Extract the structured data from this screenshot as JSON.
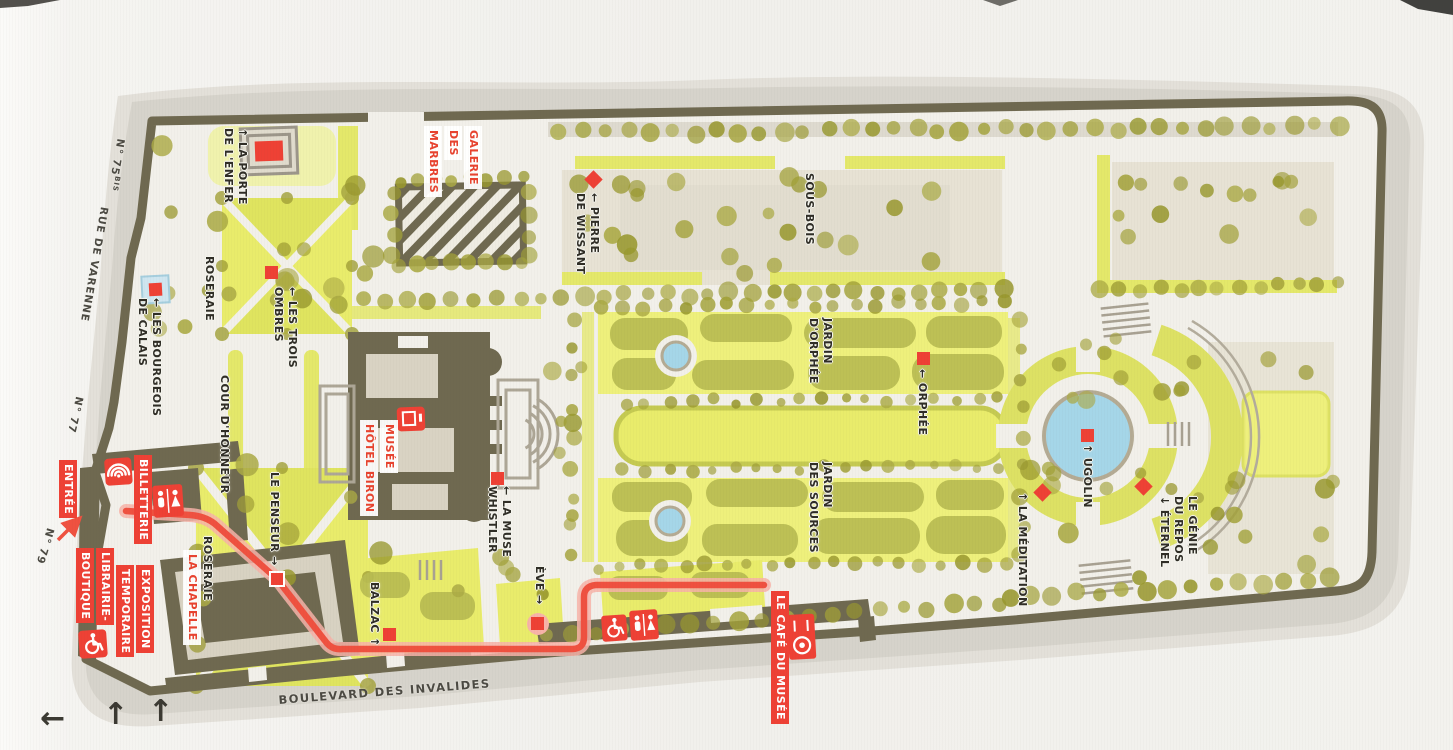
{
  "colors": {
    "accent_red": "#ee4135",
    "wall_olive": "#6f6950",
    "lawn_bright": "#e9ec6b",
    "lawn_band": "#dde164",
    "hedge_olive": "#b9bc52",
    "water_blue": "#a5d6e8",
    "tree_olive": "#a2a138",
    "paper": "#f2f0ea"
  },
  "streets": {
    "rue_de_varenne": "RUE DE VARENNE",
    "boulevard_des_invalides": "BOULEVARD DES INVALIDES",
    "n75": "N° 75",
    "n75_sup": "BIS",
    "n77": "N° 77",
    "n79": "N° 79"
  },
  "arrows": {
    "west": "←",
    "up1": "↑",
    "up2": "↑"
  },
  "garden_labels": [
    {
      "id": "la-porte-de-l-enfer",
      "lines": [
        "↑ LA PORTE",
        "DE L'ENFER"
      ]
    },
    {
      "id": "roseraie-nord",
      "lines": [
        "ROSERAIE"
      ]
    },
    {
      "id": "les-trois-ombres",
      "lines": [
        "← LES TROIS",
        "OMBRES"
      ]
    },
    {
      "id": "les-bourgeois-de-calais",
      "lines": [
        "← LES BOURGEOIS",
        "DE CALAIS"
      ]
    },
    {
      "id": "cour-d-honneur",
      "lines": [
        "COUR D'HONNEUR"
      ]
    },
    {
      "id": "pierre-de-wissant",
      "lines": [
        "← PIERRE",
        "DE WISSANT"
      ]
    },
    {
      "id": "sous-bois",
      "lines": [
        "SOUS-BOIS"
      ]
    },
    {
      "id": "la-muse-whistler",
      "lines": [
        "← LA MUSE",
        "WHISTLER"
      ]
    },
    {
      "id": "le-penseur",
      "lines": [
        "LE PENSEUR →"
      ]
    },
    {
      "id": "roseraie-sud",
      "lines": [
        "ROSERAIE"
      ]
    },
    {
      "id": "balzac",
      "lines": [
        "BALZAC ↑"
      ]
    },
    {
      "id": "eve",
      "lines": [
        "ÈVE →"
      ]
    },
    {
      "id": "jardin-d-orphee",
      "lines": [
        "JARDIN",
        "D'ORPHÉE"
      ]
    },
    {
      "id": "orphee",
      "lines": [
        "← ORPHÉE"
      ]
    },
    {
      "id": "jardin-des-sources",
      "lines": [
        "JARDIN",
        "DES SOURCES"
      ]
    },
    {
      "id": "ugolin",
      "lines": [
        "↑ UGOLIN"
      ]
    },
    {
      "id": "la-meditation",
      "lines": [
        "↑ LA MÉDITATION"
      ]
    },
    {
      "id": "le-genie-du-repos-eternel",
      "lines": [
        "LE GÉNIE",
        "DU REPOS",
        "↓ ÉTERNEL"
      ]
    }
  ],
  "facility_labels": [
    {
      "id": "entree",
      "lines": [
        "ENTRÉE"
      ]
    },
    {
      "id": "billetterie",
      "lines": [
        "BILLETTERIE"
      ]
    },
    {
      "id": "librairie-boutique",
      "lines": [
        "LIBRAIRIE-",
        "BOUTIQUE"
      ]
    },
    {
      "id": "exposition-temporaire",
      "lines": [
        "EXPOSITION",
        "TEMPORAIRE"
      ]
    },
    {
      "id": "le-cafe-du-musee",
      "lines": [
        "LE CAFÉ DU MUSÉE"
      ]
    },
    {
      "id": "la-chapelle",
      "lines": [
        "LA CHAPELLE"
      ]
    },
    {
      "id": "musee-hotel-biron",
      "lines": [
        "MUSÉE",
        "HÔTEL BIRON"
      ]
    },
    {
      "id": "galerie-des-marbres",
      "lines": [
        "GALERIE",
        "DES",
        "MARBRES"
      ]
    }
  ],
  "icons": [
    "entrance-arcs-icon",
    "restrooms-icon",
    "wheelchair-access-icon",
    "wheelchair-access-icon-2",
    "restrooms-icon-2",
    "cafe-icon",
    "entrance-arrow-icon"
  ]
}
